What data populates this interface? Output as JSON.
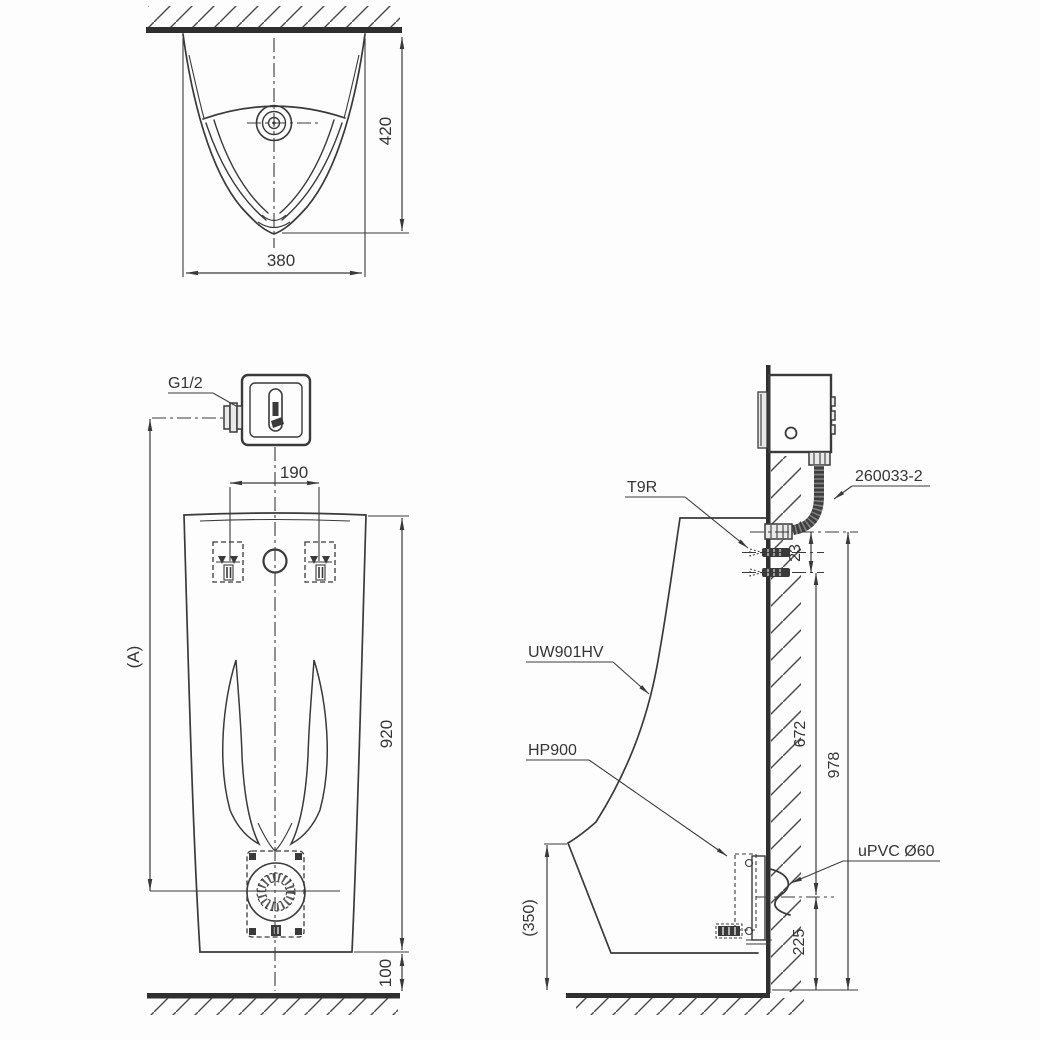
{
  "colors": {
    "background": "#fdfdfd",
    "line": "#3a3a3a",
    "wall": "#2f2f2f"
  },
  "views": {
    "top": {
      "dim_height": "420",
      "dim_width": "380"
    },
    "front": {
      "inlet_thread": "G1/2",
      "dim_bolt_spacing": "190",
      "dim_ref_height": "(A)",
      "dim_body_height": "920",
      "dim_floor_gap": "100"
    },
    "side": {
      "label_spreader": "T9R",
      "label_hose": "260033-2",
      "label_model": "UW901HV",
      "label_trap": "HP900",
      "label_drain_pipe": "uPVC Ø60",
      "dim_inlet_offset": "23",
      "dim_spreader_height": "672",
      "dim_supply_height": "978",
      "dim_drain_height": "225",
      "dim_lip_height": "(350)"
    }
  }
}
